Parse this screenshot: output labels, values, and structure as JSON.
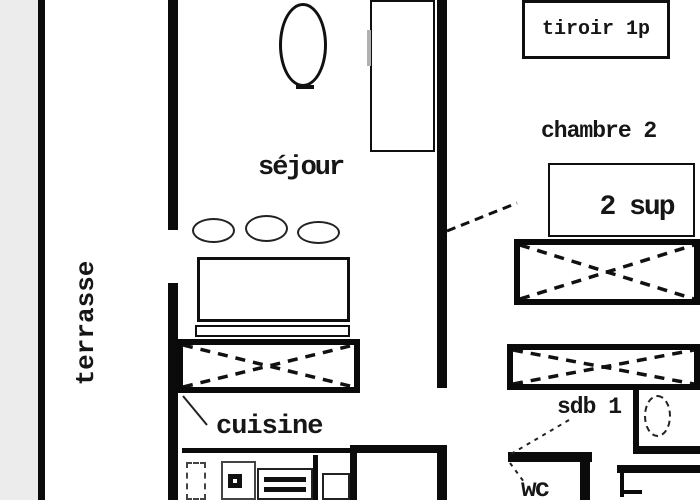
{
  "title": "apartment floor plan",
  "colors": {
    "background": "#ffffff",
    "line": "#0b0b0b",
    "outside_area": "#ececec",
    "text": "#161616"
  },
  "rooms": {
    "terrace_label": "terrasse",
    "living_room_label": "séjour",
    "kitchen_label": "cuisine",
    "bedroom_label": "chambre 2",
    "bathroom_label": "sdb 1",
    "wc_label": "wc"
  },
  "annotations": {
    "drawer_box_label": "tiroir 1p",
    "extra_sleeping_box_label": "2 sup"
  }
}
